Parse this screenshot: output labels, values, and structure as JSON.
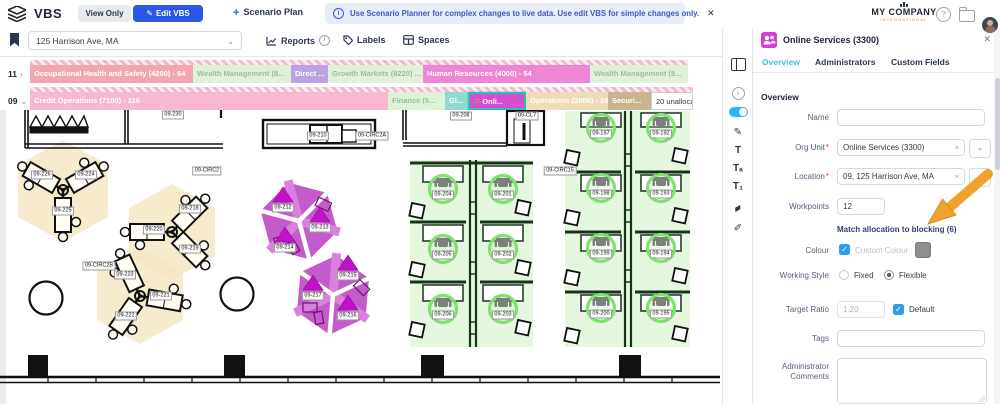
{
  "topbar": {
    "app_title": "VBS",
    "view_only": "View Only",
    "edit_vbs": "Edit VBS",
    "edit_vbs_pen": "✎",
    "scenario_plus": "+",
    "scenario_plan": "Scenario Plan",
    "banner_text": "Use Scenario Planner for complex changes to live data. Use edit VBS for simple changes only.",
    "banner_close": "✕",
    "banner_info": "i",
    "company_line1": "MY COMPANY",
    "company_line2": "INTERNATIONAL",
    "help_glyph": "?"
  },
  "toolrow": {
    "location_value": "125 Harrison Ave, MA",
    "location_chevron": "⌄",
    "reports": "Reports",
    "reports_info": "i",
    "labels": "Labels",
    "spaces": "Spaces"
  },
  "counts": [
    {
      "top": "1247",
      "bottom": "687"
    },
    {
      "top": "209",
      "bottom": "98"
    },
    {
      "top": "209",
      "bottom": "139"
    }
  ],
  "blocking": {
    "rows": [
      {
        "id": "11",
        "chevron": "›",
        "y_hatch": 3,
        "y_bar": 8,
        "width": 658,
        "segments": [
          {
            "label": "Occupational Health and Safety (4200) - 64",
            "bg": "#f4a6b0",
            "fg": "#ffffff",
            "w": 163
          },
          {
            "label": "Wealth Management (8...",
            "bg": "#dcf3d8",
            "fg": "#9fb8a2",
            "w": 98
          },
          {
            "label": "Direct ...",
            "bg": "#b9a3e3",
            "fg": "#ffffff",
            "w": 37
          },
          {
            "label": "Growth Markets (8220) ...",
            "bg": "#dcf3d8",
            "fg": "#9fb8a2",
            "w": 95
          },
          {
            "label": "Human Resources (4000) - 54",
            "bg": "#ef85d5",
            "fg": "#ffffff",
            "w": 167
          },
          {
            "label": "Wealth Management (8...",
            "bg": "#dcf3d8",
            "fg": "#9fb8a2",
            "w": 98
          }
        ]
      },
      {
        "id": "09",
        "chevron": "⌄",
        "y_hatch": 30,
        "y_bar": 35,
        "width": 663,
        "segments": [
          {
            "label": "Credit Operations (7100) - 116",
            "bg": "#f8b8d2",
            "fg": "#ffffff",
            "w": 358
          },
          {
            "label": "Finance (5...",
            "bg": "#dcf3d8",
            "fg": "#9fb8a2",
            "w": 57
          },
          {
            "label": "Gl...",
            "bg": "#8fd9d2",
            "fg": "#ffffff",
            "w": 23
          },
          {
            "label": "Onli...",
            "bg": "#d44fd0",
            "fg": "#ffffff",
            "w": 58,
            "selected": true,
            "warn": "⚠"
          },
          {
            "label": "Operations (2000) - 29",
            "bg": "#eeddb9",
            "fg": "#ffffff",
            "w": 82
          },
          {
            "label": "Securi...",
            "bg": "#c9b491",
            "fg": "#ffffff",
            "w": 43
          },
          {
            "label": "20 unallocated...",
            "bg": "#ffffff",
            "fg": "#333333",
            "w": 42,
            "unalloc": true
          }
        ]
      }
    ]
  },
  "icon_strip": [
    {
      "name": "panel-toggle-icon",
      "kind": "split",
      "y": 30
    },
    {
      "name": "info-icon",
      "kind": "ring",
      "glyph": "i",
      "y": 54
    },
    {
      "name": "blocking-toggle",
      "kind": "toggle",
      "y": 76
    },
    {
      "name": "pen-icon",
      "kind": "glyph",
      "glyph": "✎",
      "y": 94
    },
    {
      "name": "label-large-icon",
      "kind": "glyph",
      "glyph": "T",
      "y": 112
    },
    {
      "name": "label-medium-icon",
      "kind": "glyph",
      "glyph": "Tₐ",
      "y": 130
    },
    {
      "name": "label-small-icon",
      "kind": "glyph",
      "glyph": "T₁",
      "y": 148
    },
    {
      "name": "eraser-icon",
      "kind": "glyph rot",
      "glyph": "▰",
      "y": 170
    },
    {
      "name": "fill-icon",
      "kind": "glyph",
      "glyph": "✐",
      "y": 190
    }
  ],
  "floorplan": {
    "labels": [
      {
        "t": "09-230",
        "x": 173,
        "y": 5,
        "k": "room"
      },
      {
        "t": "09-208",
        "x": 461,
        "y": 6,
        "k": "room"
      },
      {
        "t": "09-CL7",
        "x": 527,
        "y": 6,
        "k": "room"
      },
      {
        "t": "09-210",
        "x": 318,
        "y": 26,
        "k": "room"
      },
      {
        "t": "09-CIRC2A",
        "x": 372,
        "y": 26,
        "k": "room"
      },
      {
        "t": "09-CIRC2",
        "x": 207,
        "y": 61,
        "k": "room"
      },
      {
        "t": "09-CIRC15",
        "x": 560,
        "y": 61,
        "k": "room"
      },
      {
        "t": "09-CIRC2B",
        "x": 99,
        "y": 156,
        "k": "room"
      },
      {
        "t": "09-226",
        "x": 42,
        "y": 65,
        "k": "desk"
      },
      {
        "t": "09-224",
        "x": 86,
        "y": 65,
        "k": "desk"
      },
      {
        "t": "09-225",
        "x": 63,
        "y": 101,
        "k": "desk"
      },
      {
        "t": "09-218",
        "x": 190,
        "y": 99,
        "k": "desk"
      },
      {
        "t": "09-220",
        "x": 154,
        "y": 120,
        "k": "desk"
      },
      {
        "t": "09-219",
        "x": 190,
        "y": 139,
        "k": "desk"
      },
      {
        "t": "09-223",
        "x": 125,
        "y": 165,
        "k": "desk"
      },
      {
        "t": "09-221",
        "x": 161,
        "y": 186,
        "k": "desk"
      },
      {
        "t": "09-222",
        "x": 126,
        "y": 206,
        "k": "desk"
      },
      {
        "t": "09-212",
        "x": 283,
        "y": 98,
        "k": "hex"
      },
      {
        "t": "09-213",
        "x": 320,
        "y": 118,
        "k": "hex"
      },
      {
        "t": "09-214",
        "x": 285,
        "y": 138,
        "k": "hex"
      },
      {
        "t": "09-215",
        "x": 348,
        "y": 166,
        "k": "hex"
      },
      {
        "t": "09-217",
        "x": 313,
        "y": 186,
        "k": "hex"
      },
      {
        "t": "09-216",
        "x": 348,
        "y": 206,
        "k": "hex"
      },
      {
        "t": "09-204",
        "x": 443,
        "y": 85,
        "k": "green"
      },
      {
        "t": "09-201",
        "x": 503,
        "y": 85,
        "k": "green"
      },
      {
        "t": "09-205",
        "x": 443,
        "y": 145,
        "k": "green"
      },
      {
        "t": "09-202",
        "x": 503,
        "y": 145,
        "k": "green"
      },
      {
        "t": "09-206",
        "x": 443,
        "y": 205,
        "k": "green"
      },
      {
        "t": "09-203",
        "x": 503,
        "y": 205,
        "k": "green"
      },
      {
        "t": "09-197",
        "x": 601,
        "y": 24,
        "k": "green"
      },
      {
        "t": "09-192",
        "x": 661,
        "y": 24,
        "k": "green"
      },
      {
        "t": "09-198",
        "x": 601,
        "y": 84,
        "k": "green"
      },
      {
        "t": "09-193",
        "x": 661,
        "y": 84,
        "k": "green"
      },
      {
        "t": "09-199",
        "x": 601,
        "y": 144,
        "k": "green"
      },
      {
        "t": "09-194",
        "x": 661,
        "y": 144,
        "k": "green"
      },
      {
        "t": "09-200",
        "x": 601,
        "y": 204,
        "k": "green"
      },
      {
        "t": "09-195",
        "x": 661,
        "y": 204,
        "k": "green"
      }
    ]
  },
  "panel": {
    "title": "Online Services (3300)",
    "close": "✕",
    "tabs": [
      "Overview",
      "Administrators",
      "Custom Fields"
    ],
    "section": "Overview",
    "required_marker": "*",
    "clear_glyph": "×",
    "chevron": "⌄",
    "check": "✓",
    "fields": {
      "name_label": "Name",
      "org_unit_label": "Org Unit",
      "org_unit_value": "Online Services (3300)",
      "location_label": "Location",
      "location_value": "09, 125 Harrison Ave, MA",
      "workpoints_label": "Workpoints",
      "workpoints_value": "12",
      "match_link": "Match allocation to blocking (6)",
      "colour_label": "Colour",
      "custom_colour_label": "Custom Colour",
      "working_style_label": "Working Style",
      "fixed_label": "Fixed",
      "flexible_label": "Flexible",
      "target_ratio_label": "Target Ratio",
      "target_ratio_value": "1.20",
      "default_label": "Default",
      "tags_label": "Tags",
      "admin_comments_label_1": "Administrator",
      "admin_comments_label_2": "Comments"
    }
  },
  "colors": {
    "accent_blue": "#2d55e8",
    "tab_active": "#45bde8",
    "selection_teal": "#2fbfae",
    "hex_magenta": "#c45bca",
    "hex_triangle": "#c013c9",
    "green_fill": "#e6f7e0",
    "green_ring": "#7fe26e",
    "beige_glow": "#f6e8c6",
    "arrow_orange": "#efa32e",
    "swatch_gray": "#8e8e8e",
    "checkbox_blue": "#2e9df0"
  }
}
